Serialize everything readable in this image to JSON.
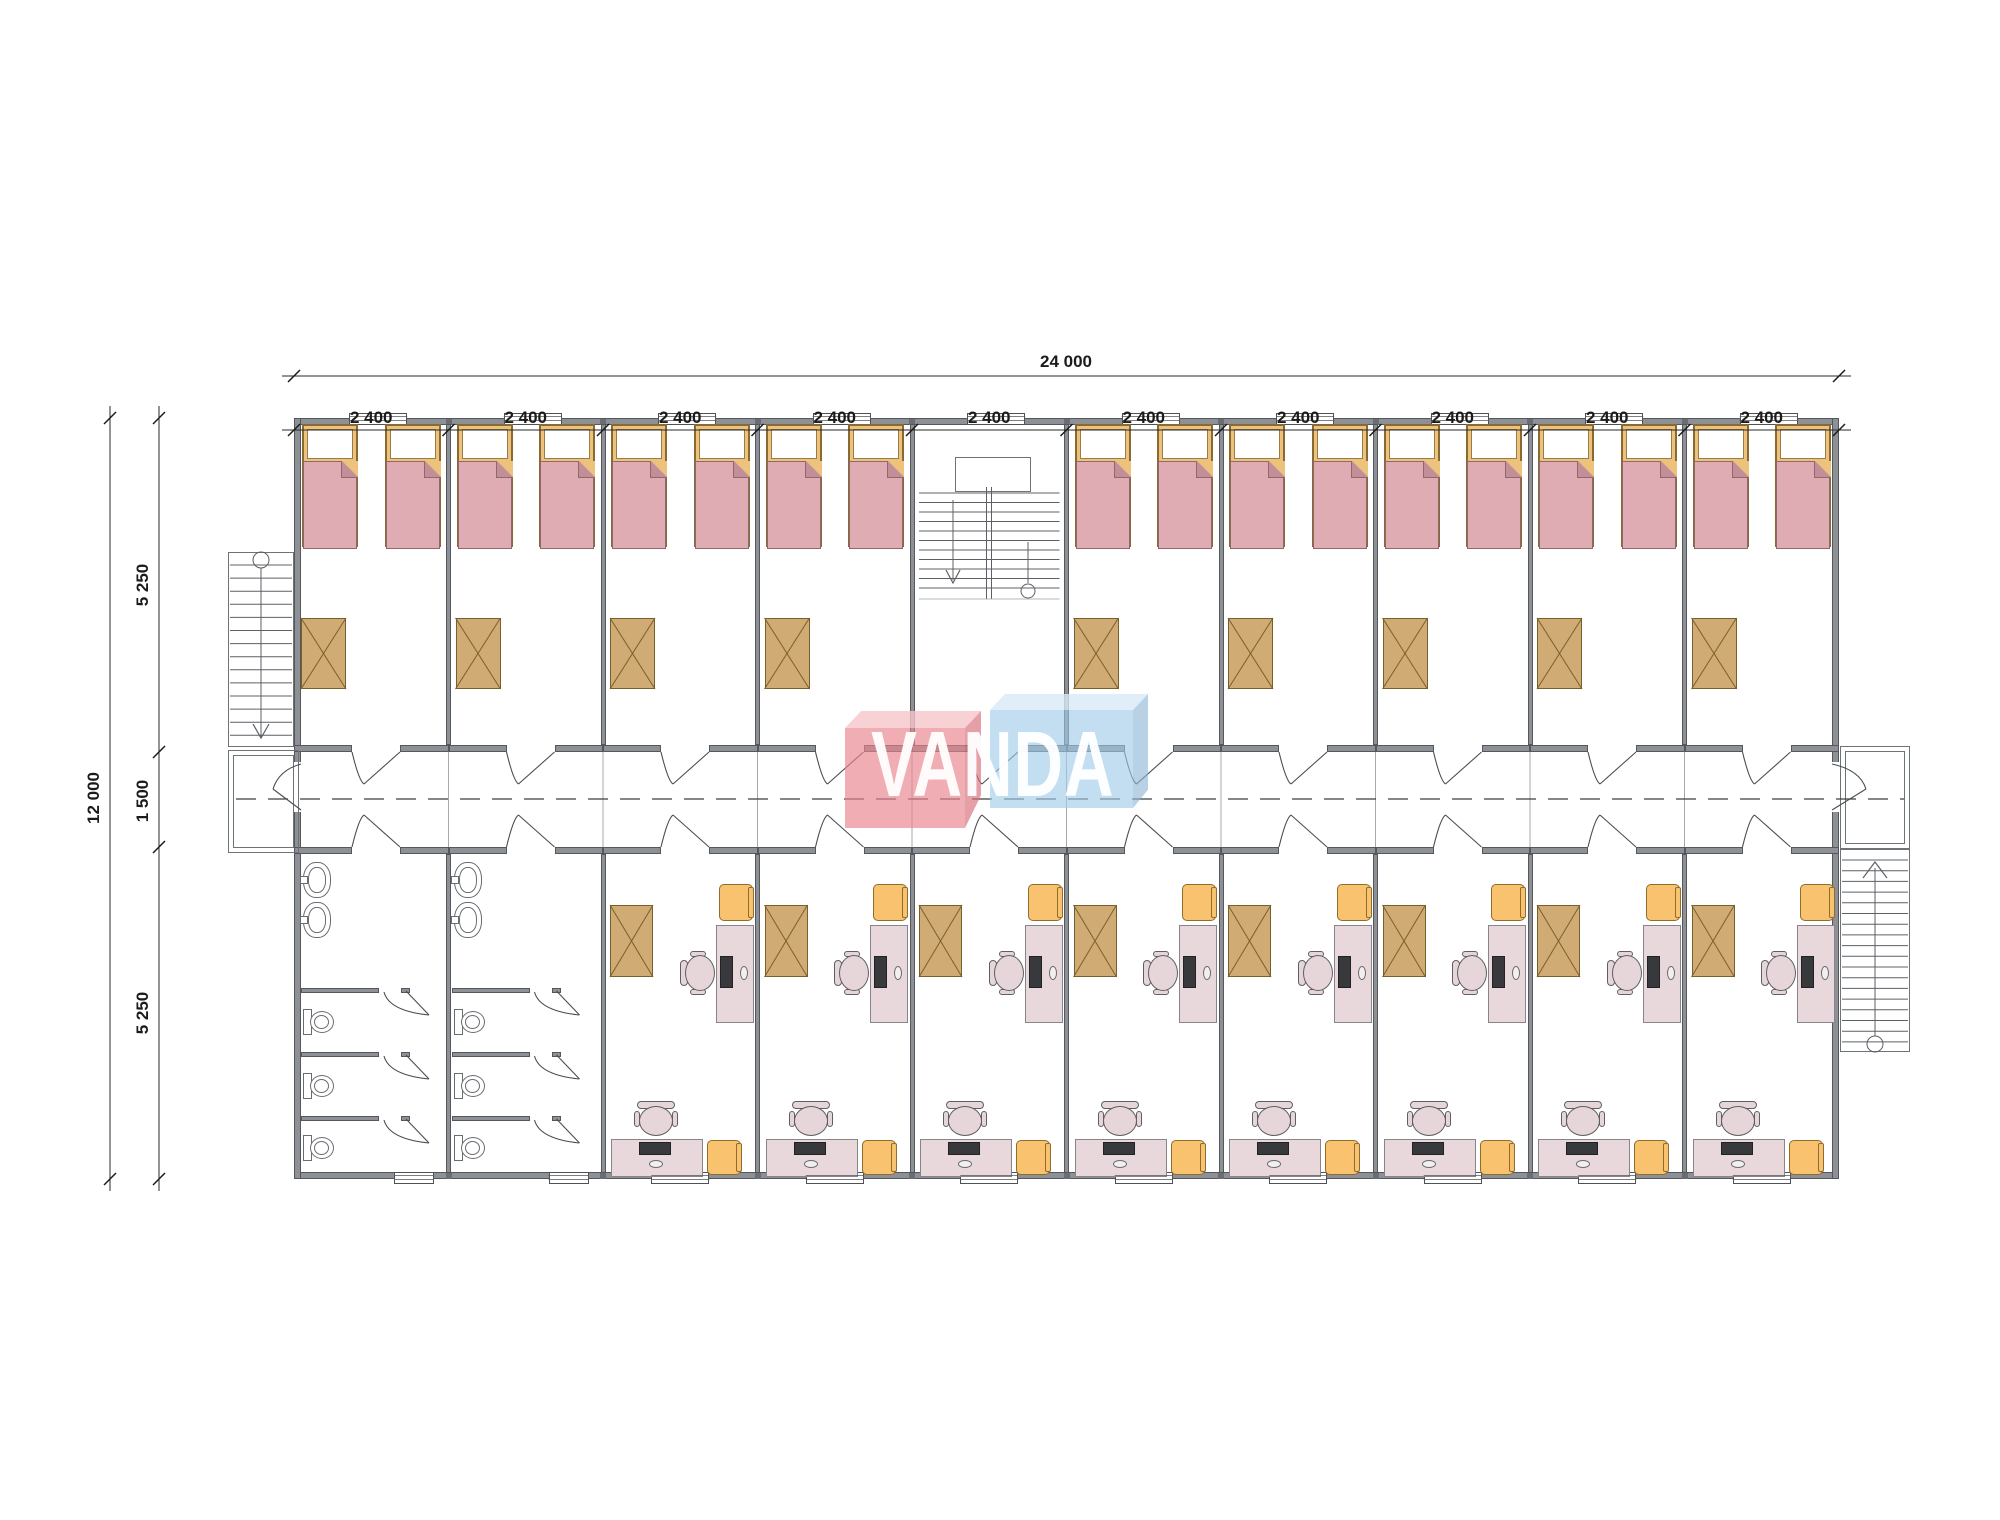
{
  "page": {
    "background": "#ffffff",
    "kind": "modular building floor plan"
  },
  "logo": {
    "text": "VANDA"
  },
  "dimensions": {
    "top_total": "24 000",
    "top_segments": [
      "2 400",
      "2 400",
      "2 400",
      "2 400",
      "2 400",
      "2 400",
      "2 400",
      "2 400",
      "2 400",
      "2 400"
    ],
    "left_total": "12 000",
    "left_segments": [
      "5 250",
      "1 500",
      "5 250"
    ]
  },
  "plan": {
    "bays": 10,
    "stair_bay_index": 4,
    "bathroom_bay_indices": [
      0,
      1
    ],
    "bedrooms_top": 9,
    "beds_per_bedroom": 2,
    "offices_bottom": 8,
    "bathrooms_bottom": 2,
    "sinks_per_bathroom": 2,
    "toilets_per_bathroom": 3,
    "stairs": [
      "left-exterior",
      "central",
      "right-exterior"
    ]
  },
  "colors": {
    "wall": "#8d9196",
    "wall_edge": "#54585d",
    "joint_mark": "#6a6e73",
    "line": "#4a4e53",
    "stair_line": "#5c6065",
    "bed_frame": "#edc27c",
    "bed_blanket": "#deacb2",
    "bed_fold": "#c28f98",
    "table": "#d0ab74",
    "table_edge": "#7a5f2e",
    "desk": "#e8d7db",
    "chair_orange": "#f8c26f",
    "logo_pink_front": "rgba(232,130,140,0.66)",
    "logo_pink_top": "rgba(246,198,203,0.8)",
    "logo_pink_side": "rgba(214,110,122,0.66)",
    "logo_blue_front": "rgba(160,202,232,0.62)",
    "logo_blue_top": "rgba(215,234,247,0.8)",
    "logo_blue_side": "rgba(140,180,212,0.62)",
    "logo_text": "rgba(255,255,255,0.95)"
  }
}
